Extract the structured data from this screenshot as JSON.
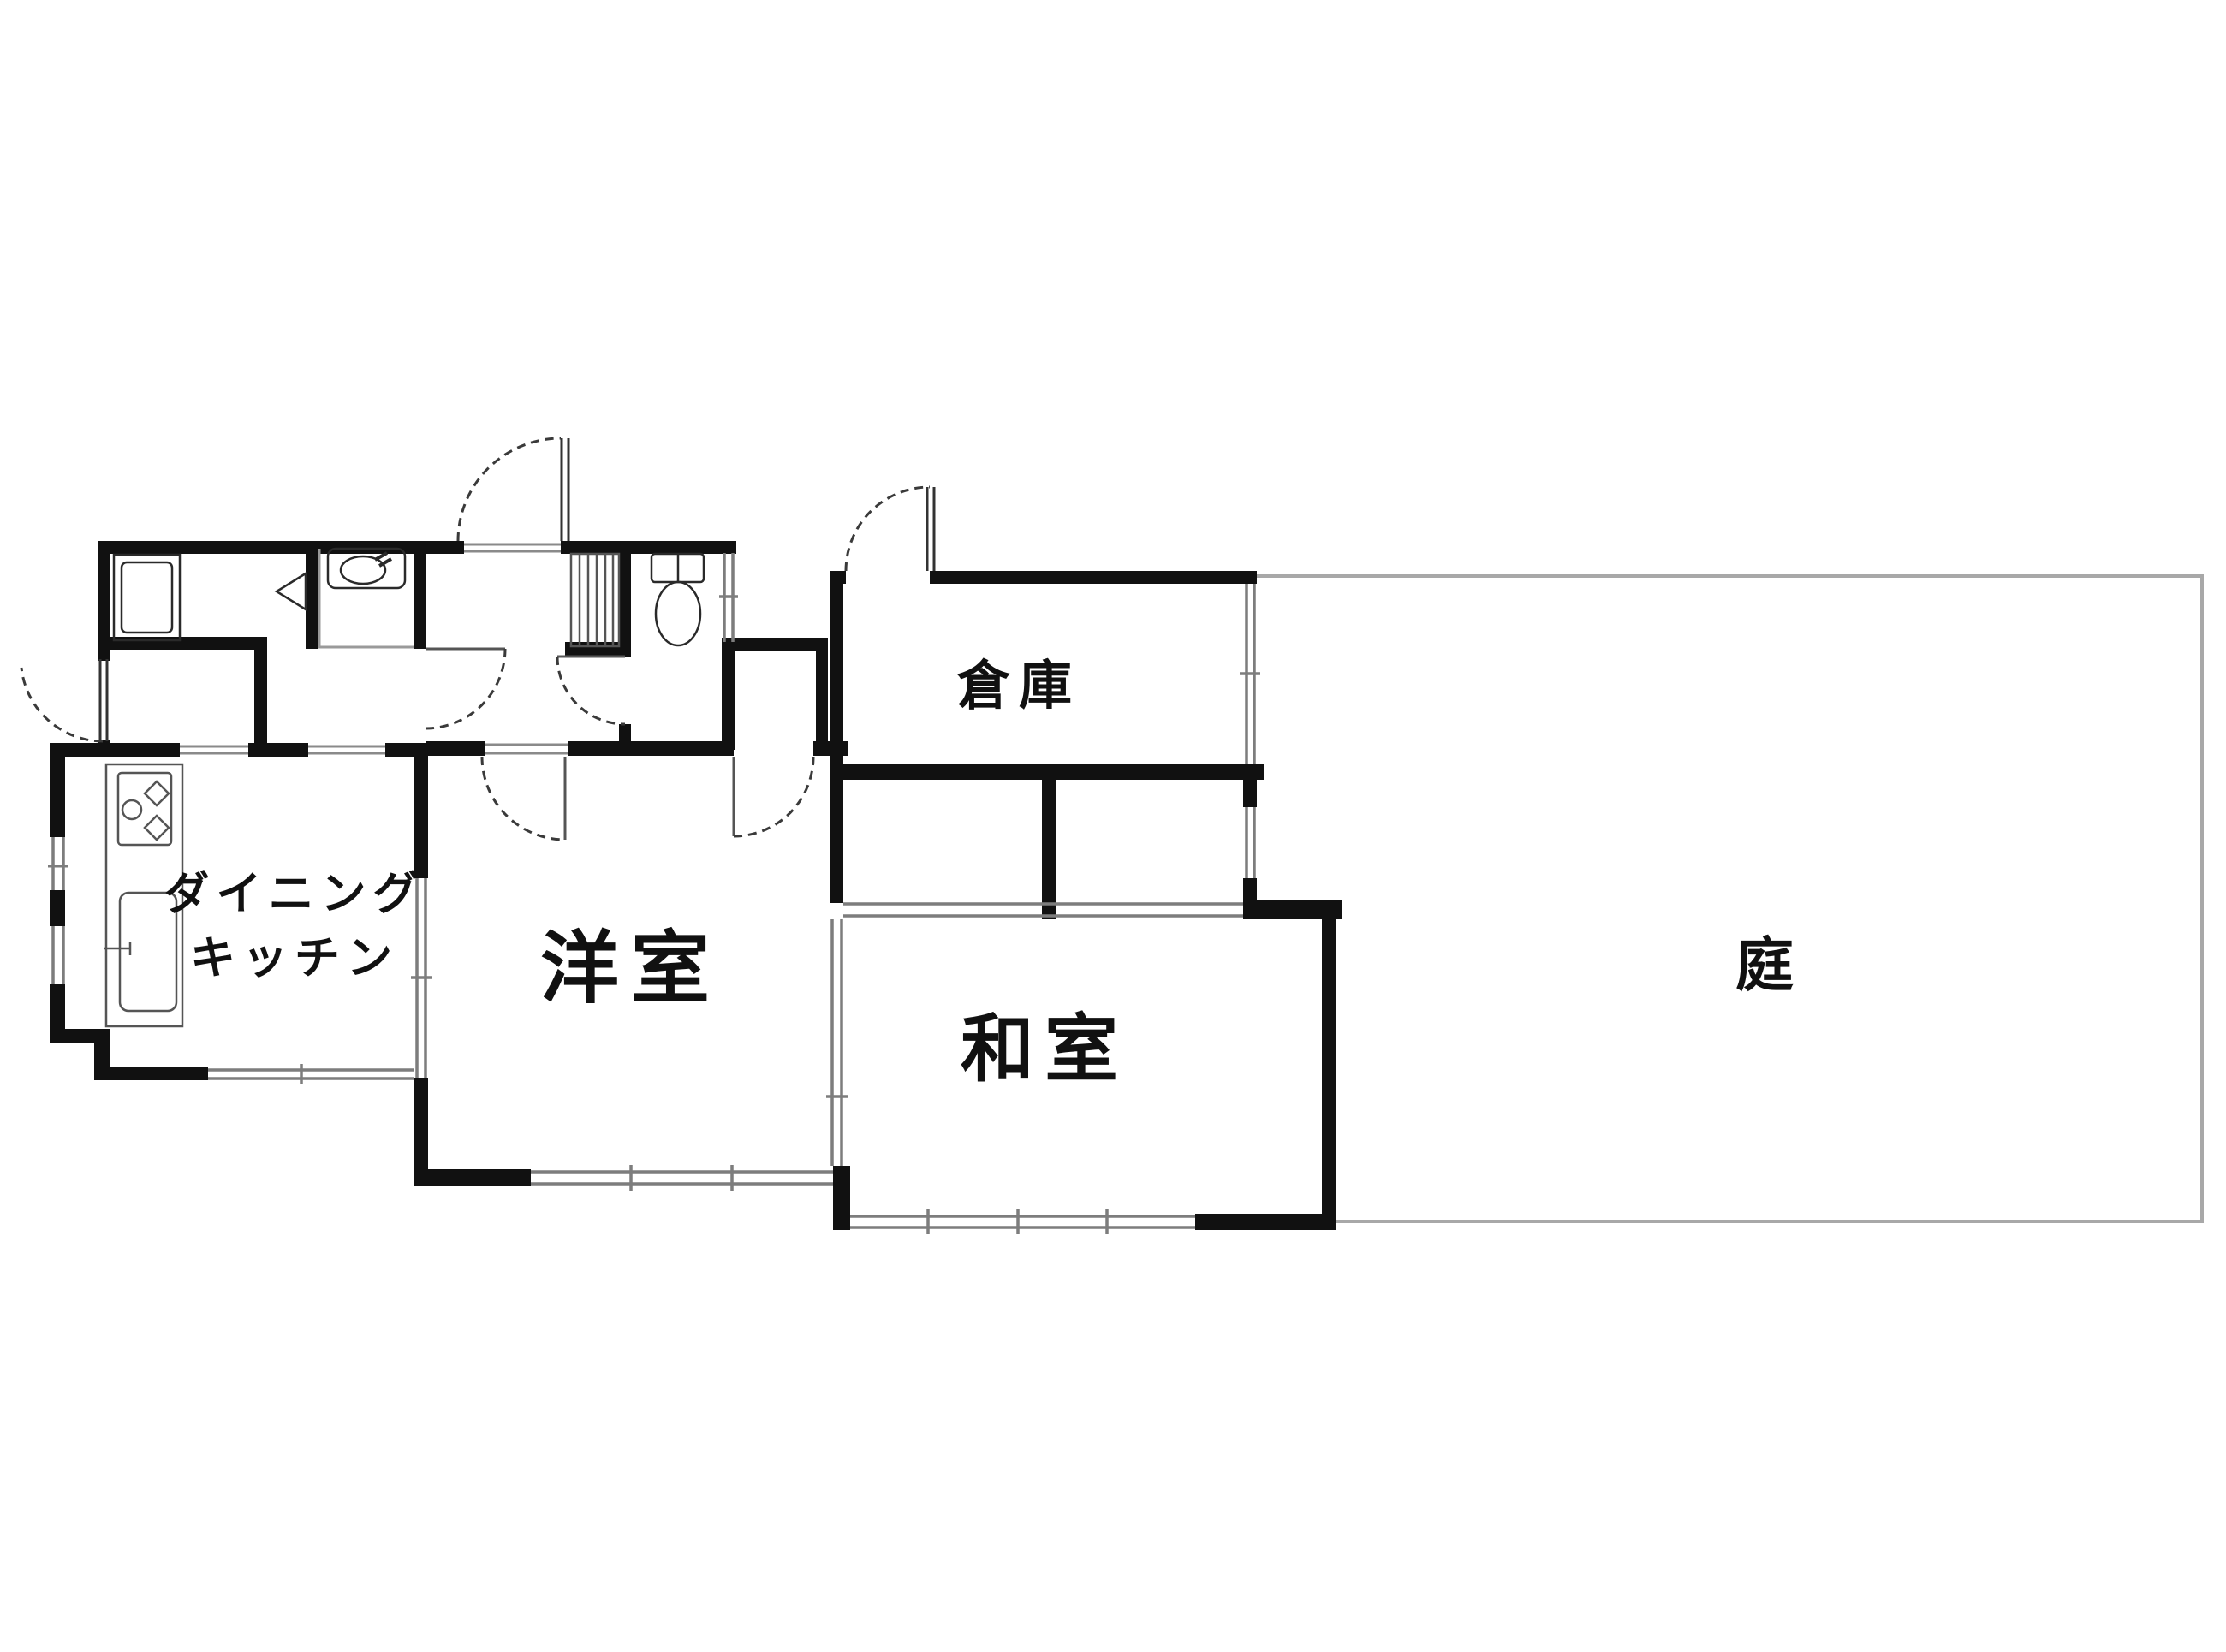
{
  "document": {
    "type": "japanese-floor-plan",
    "background_color": "#ffffff"
  },
  "labels": {
    "storage": "倉庫",
    "garden": "庭",
    "western_room": "洋室",
    "japanese_room": "和室",
    "dining_kitchen_line1": "ダイニング",
    "dining_kitchen_line2": "キッチン"
  },
  "colors": {
    "wall": "#111111",
    "thin_line": "#444444",
    "rail_line": "#8a8a8a",
    "garden_line": "#a8a8a8",
    "door_arc": "#3a3a3a",
    "text": "#111111"
  },
  "fixtures": [
    "washing-machine-icon",
    "washbasin-icon",
    "toilet-icon",
    "shoe-shelf-icon",
    "stove-icon",
    "kitchen-sink-icon"
  ],
  "doors": [
    "entrance-door",
    "back-door",
    "storage-door",
    "toilet-door",
    "washroom-door",
    "western-room-door",
    "closet-door",
    "dk-sliding-door",
    "japanese-room-sliding-door",
    "closet-fusuma"
  ]
}
